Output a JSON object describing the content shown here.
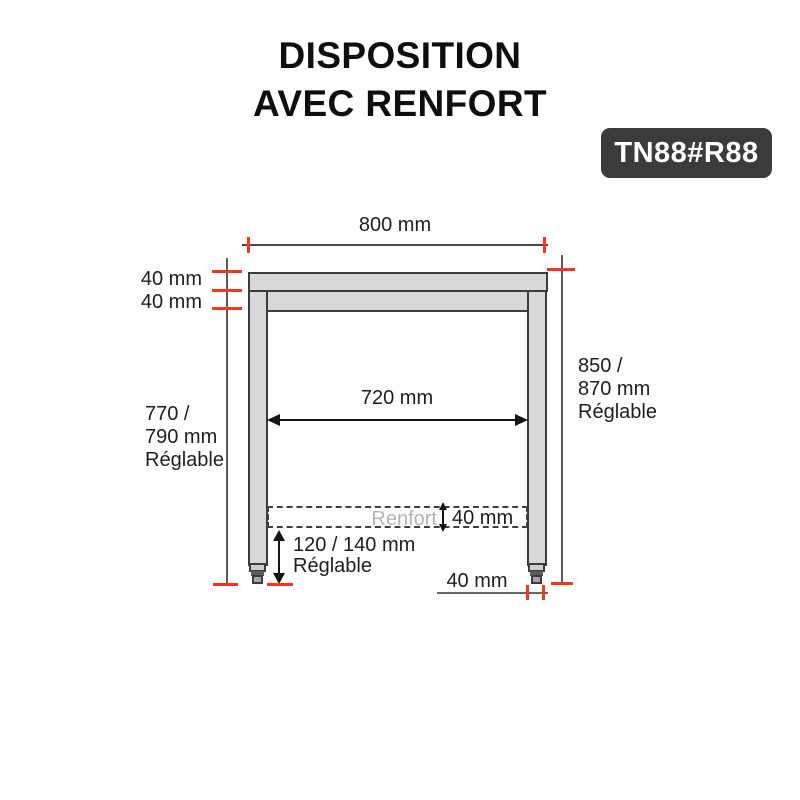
{
  "title": {
    "line1": "DISPOSITION",
    "line2": "AVEC RENFORT"
  },
  "badge": {
    "code": "TN88#R88"
  },
  "diagram": {
    "top_width_label": "800 mm",
    "top_thickness_label": "40 mm",
    "apron_thickness_label": "40 mm",
    "inner_width_label": "720 mm",
    "left_height": {
      "line1": "770 /",
      "line2": "790 mm",
      "line3": "Réglable"
    },
    "right_height": {
      "line1": "850 /",
      "line2": "870 mm",
      "line3": "Réglable"
    },
    "renfort": {
      "label": "Renfort",
      "thickness_label": "40 mm"
    },
    "foot_height": {
      "line1": "120 / 140 mm",
      "line2": "Réglable"
    },
    "leg_width_label": "40 mm"
  },
  "colors": {
    "accent_red": "#f8341c",
    "steel_fill": "#d9d9d9",
    "outline": "#3c3c3c",
    "badge_bg": "#3b3b3d",
    "muted_text": "#b4b4b4"
  }
}
